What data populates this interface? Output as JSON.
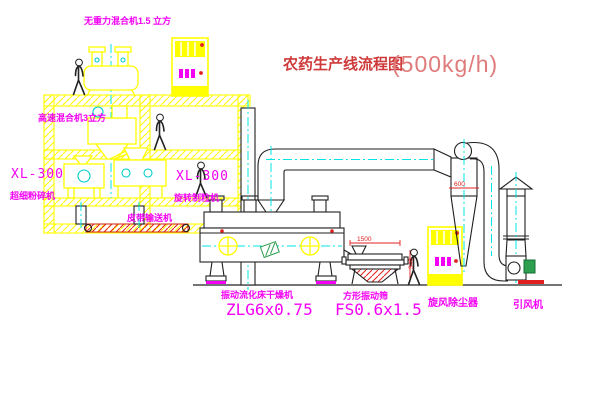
{
  "title": {
    "main": "农药生产线流程图",
    "capacity": "(500kg/h)"
  },
  "labels": {
    "gravity_free_mixer": "无重力混合机1.5 立方",
    "high_speed_mixer": "高速混合机3立方",
    "pulverizer_model": "XL-300",
    "pulverizer_name": "超细粉碎机",
    "granulator_model": "XL-300",
    "granulator_name": "旋转制粒机",
    "belt_conveyor": "皮带输送机",
    "dryer_name": "振动流化床干燥机",
    "dryer_model": "ZLG6x0.75",
    "screen_name": "方形振动筛",
    "screen_model": "FS0.6x1.5",
    "cyclone": "旋风除尘器",
    "induced_draft_fan": "引风机"
  },
  "dimensions": {
    "screen_length": "1500",
    "screen_height": "340",
    "cyclone_body": "600"
  },
  "colors": {
    "structure_yellow": "#ffff00",
    "centerline_cyan": "#00e5e5",
    "label_magenta": "#f400f4",
    "title_red": "#cf3a3a",
    "title_capacity_red": "#e07b7b",
    "dimension_red": "#e02020",
    "outline_black": "#1f1f1f",
    "motor_green": "#2e9e4f",
    "background": "#ffffff"
  }
}
